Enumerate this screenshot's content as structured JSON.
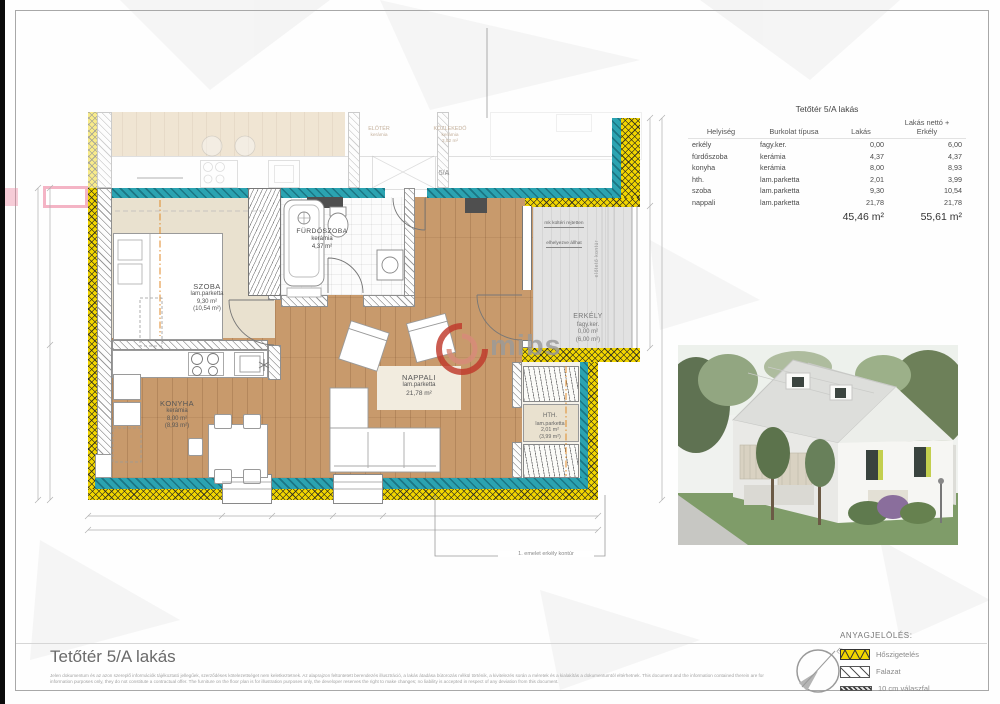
{
  "page": {
    "title": "Tetőtér 5/A lakás",
    "disclaimer_hu": "Jelen dokumentum és az azon szereplő információk tájékoztató jellegűek, szerződéses kötelezettséget nem keletkeztetnek. Az alaprajzon feltüntetett berendezés illusztráció, a lakás átadása bútorozás nélkül történik, a kivitelezés során a méretek és a kialakítás a dokumentumtól eltérhetnek.",
    "disclaimer_en": "This document and the information contained therein are for information purposes only, they do not constitute a contractual offer. The furniture on the floor plan is for illustration purposes only, the developer reserves the right to make changes; no liability is accepted in respect of any deviation from this document."
  },
  "watermark": {
    "text": "mibs"
  },
  "area_table": {
    "title": "Tetőtér 5/A lakás",
    "headers": {
      "room": "Helyiség",
      "flooring": "Burkolat típusa",
      "apartment": "Lakás",
      "net": "Lakás nettó +\nErkély"
    },
    "rows": [
      {
        "room": "erkély",
        "floor": "fagy.ker.",
        "apt": "0,00",
        "net": "6,00"
      },
      {
        "room": "fürdőszoba",
        "floor": "kerámia",
        "apt": "4,37",
        "net": "4,37"
      },
      {
        "room": "konyha",
        "floor": "kerámia",
        "apt": "8,00",
        "net": "8,93"
      },
      {
        "room": "hth.",
        "floor": "lam.parketta",
        "apt": "2,01",
        "net": "3,99"
      },
      {
        "room": "szoba",
        "floor": "lam.parketta",
        "apt": "9,30",
        "net": "10,54"
      },
      {
        "room": "nappali",
        "floor": "lam.parketta",
        "apt": "21,78",
        "net": "21,78"
      }
    ],
    "totals": {
      "apartment": "45,46 m²",
      "net": "55,61 m²"
    }
  },
  "floor_plan": {
    "rooms": {
      "szoba": {
        "name": "SZOBA",
        "flooring": "lam.parketta",
        "area": "9,30 m²",
        "area_net": "(10,54 m²)"
      },
      "konyha": {
        "name": "KONYHA",
        "flooring": "kerámia",
        "area": "8,00 m²",
        "area_net": "(8,93 m²)"
      },
      "nappali": {
        "name": "NAPPALI",
        "flooring": "lam.parketta",
        "area": "21,78 m²"
      },
      "furdoszoba": {
        "name": "FÜRDŐSZOBA",
        "flooring": "kerámia",
        "area": "4,37 m²"
      },
      "hth": {
        "name": "HTH.",
        "flooring": "lam.parketta",
        "area": "2,01 m²",
        "area_net": "(3,99 m²)"
      },
      "erkely": {
        "name": "ERKÉLY",
        "flooring": "fagy.ker.",
        "area": "0,00 m²",
        "area_net": "(6,00 m²)"
      }
    },
    "faded_rooms": {
      "eloter": {
        "name": "ELŐTÉR",
        "flooring": "kerámia"
      },
      "kozlekedo": {
        "name": "KÖZLEKEDŐ",
        "flooring": "kerámia",
        "area": "3,52 m²"
      },
      "unit_door": "5/A"
    },
    "annotations": {
      "balcony_note_1": "mk kültéri rejtetten",
      "balcony_note_2": "elhelyezve állhat",
      "canopy_contour": "előtető kontúr",
      "balcony_contour": "1. emelet erkély kontúr"
    }
  },
  "legend": {
    "title": "ANYAGJELÖLÉS:",
    "items": [
      {
        "label": "Hőszigetelés"
      },
      {
        "label": "Falazat"
      },
      {
        "label": "10 cm válaszfal"
      }
    ],
    "north_label": "É"
  },
  "colors": {
    "insulation_yellow": "#f2d600",
    "wall_teal": "#2ba3b1",
    "wood_floor": "#c89a6c",
    "accent_pink": "#ec82a0",
    "watermark_red": "#c0392b"
  }
}
